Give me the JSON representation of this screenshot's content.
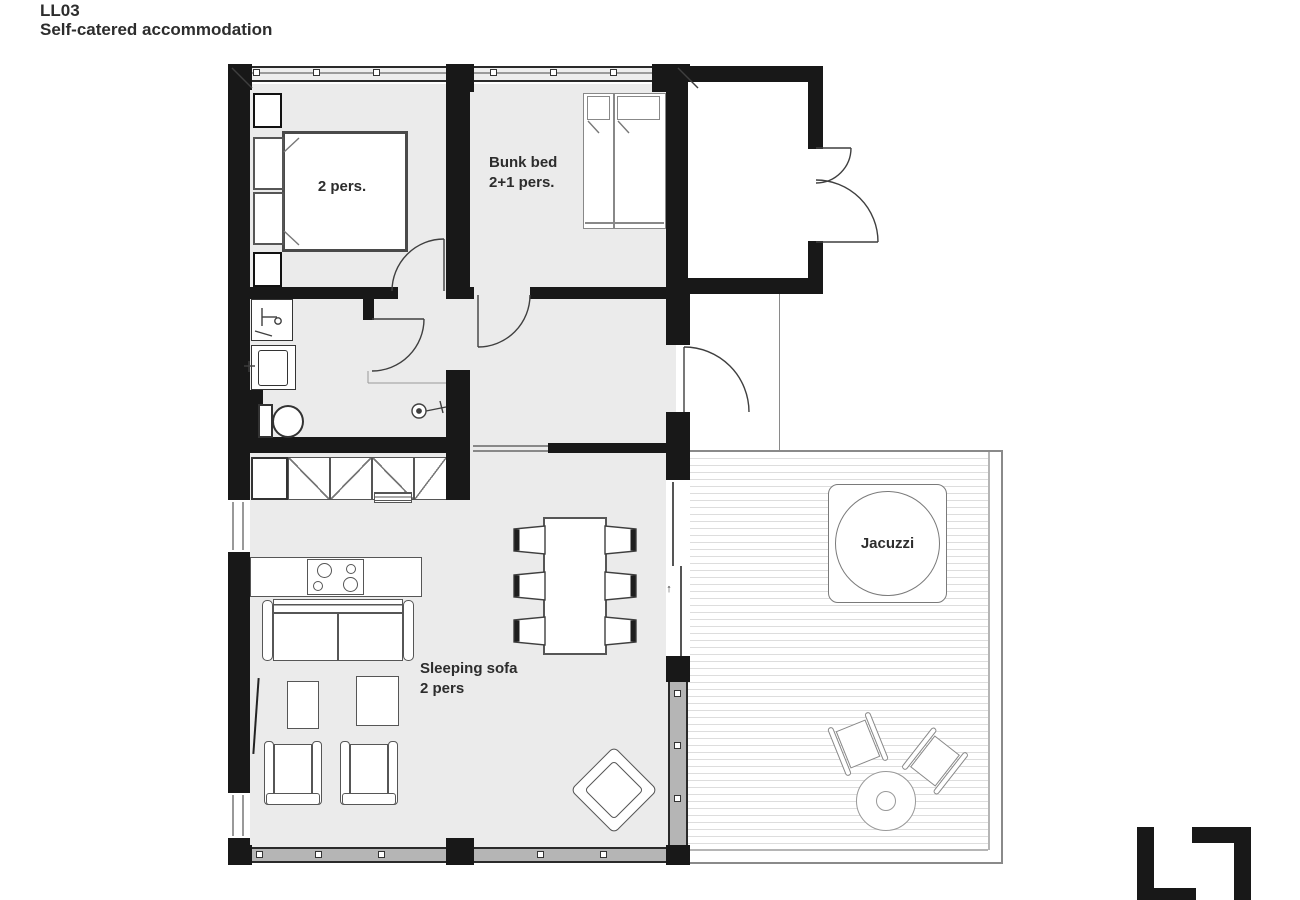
{
  "header": {
    "title": "LL03",
    "subtitle": "Self-catered accommodation"
  },
  "rooms": {
    "bedroom": {
      "label": "2 pers."
    },
    "bunk_room": {
      "label_line1": "Bunk bed",
      "label_line2": "2+1 pers."
    },
    "living_room": {
      "sofa_label_line1": "Sleeping sofa",
      "sofa_label_line2": "2 pers"
    },
    "terrace": {
      "jacuzzi_label": "Jacuzzi"
    }
  },
  "icons": {
    "slide_direction_arrow": "↑"
  },
  "colors": {
    "wall": "#181818",
    "floor": "#ebebeb",
    "furniture_line": "#565656",
    "window_band": "#b5b5b5",
    "deck_line": "#dddddd",
    "text": "#2d2d2d"
  }
}
